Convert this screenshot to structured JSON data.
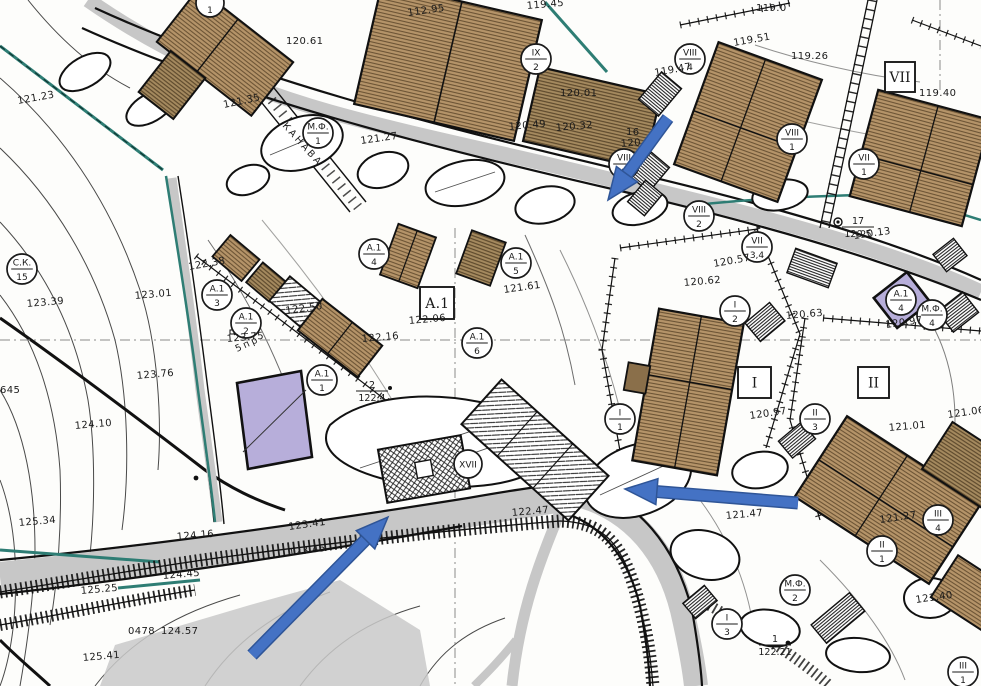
{
  "map": {
    "title": "Cadastral site plan",
    "colors": {
      "ink": "#1a1a1a",
      "building_fill": "#b59469",
      "building_line": "#6b5334",
      "road_gray": "#c7c7c7",
      "teal": "#2e7d74",
      "arrow_blue": "#4472c4",
      "arrow_blue_dark": "#2f5597",
      "highlight_purple": "#b7aeda"
    },
    "circle_labels": [
      {
        "x": 318,
        "y": 133,
        "top": "М.Ф.",
        "bot": "1"
      },
      {
        "x": 210,
        "y": 3,
        "top": "",
        "bot": "1"
      },
      {
        "x": 536,
        "y": 59,
        "top": "IX",
        "bot": "2"
      },
      {
        "x": 690,
        "y": 59,
        "top": "VIII",
        "bot": "4"
      },
      {
        "x": 624,
        "y": 164,
        "top": "VIII",
        "bot": "3"
      },
      {
        "x": 757,
        "y": 247,
        "top": "VII",
        "bot": "3,4"
      },
      {
        "x": 792,
        "y": 139,
        "top": "VIII",
        "bot": "1"
      },
      {
        "x": 864,
        "y": 164,
        "top": "VII",
        "bot": "1"
      },
      {
        "x": 699,
        "y": 216,
        "top": "VIII",
        "bot": "2"
      },
      {
        "x": 22,
        "y": 269,
        "top": "С.К.",
        "bot": "15"
      },
      {
        "x": 217,
        "y": 295,
        "top": "А.1",
        "bot": "3"
      },
      {
        "x": 246,
        "y": 323,
        "top": "А.1",
        "bot": "2"
      },
      {
        "x": 322,
        "y": 380,
        "top": "А.1",
        "bot": "1"
      },
      {
        "x": 374,
        "y": 254,
        "top": "А.1",
        "bot": "4"
      },
      {
        "x": 516,
        "y": 263,
        "top": "А.1",
        "bot": "5"
      },
      {
        "x": 477,
        "y": 343,
        "top": "А.1",
        "bot": "6"
      },
      {
        "x": 468,
        "y": 464,
        "top": "XVII",
        "bot": ""
      },
      {
        "x": 735,
        "y": 311,
        "top": "I",
        "bot": "2"
      },
      {
        "x": 815,
        "y": 419,
        "top": "II",
        "bot": "3"
      },
      {
        "x": 620,
        "y": 419,
        "top": "I",
        "bot": "1"
      },
      {
        "x": 938,
        "y": 520,
        "top": "III",
        "bot": "4"
      },
      {
        "x": 882,
        "y": 551,
        "top": "II",
        "bot": "1"
      },
      {
        "x": 795,
        "y": 590,
        "top": "М.Ф.",
        "bot": "2"
      },
      {
        "x": 727,
        "y": 624,
        "top": "I",
        "bot": "3"
      },
      {
        "x": 963,
        "y": 672,
        "top": "III",
        "bot": "1"
      },
      {
        "x": 932,
        "y": 315,
        "top": "М.Ф.",
        "bot": "4"
      },
      {
        "x": 901,
        "y": 300,
        "top": "А.1",
        "bot": "4"
      }
    ],
    "box_labels": [
      {
        "x": 885,
        "y": 62,
        "w": 30,
        "h": 30,
        "text": "VII"
      },
      {
        "x": 420,
        "y": 287,
        "w": 34,
        "h": 32,
        "text": "А.1"
      },
      {
        "x": 738,
        "y": 367,
        "w": 33,
        "h": 31,
        "text": "I"
      },
      {
        "x": 858,
        "y": 367,
        "w": 31,
        "h": 31,
        "text": "II"
      }
    ],
    "elevation_labels": [
      {
        "t": "121.23",
        "x": 18,
        "y": 104,
        "r": -10
      },
      {
        "t": "120.61",
        "x": 286,
        "y": 44,
        "r": 0
      },
      {
        "t": "112.95",
        "x": 408,
        "y": 16,
        "r": -8
      },
      {
        "t": "119.45",
        "x": 527,
        "y": 9,
        "r": -5
      },
      {
        "t": "121.35",
        "x": 224,
        "y": 108,
        "r": -12
      },
      {
        "t": "119.0",
        "x": 756,
        "y": 11,
        "r": 0
      },
      {
        "t": "119.51",
        "x": 734,
        "y": 46,
        "r": -10
      },
      {
        "t": "119.26",
        "x": 791,
        "y": 59,
        "r": 0
      },
      {
        "t": "119.40",
        "x": 919,
        "y": 96,
        "r": 0
      },
      {
        "t": "119.47",
        "x": 655,
        "y": 76,
        "r": -10
      },
      {
        "t": "120.01",
        "x": 560,
        "y": 96,
        "r": 0
      },
      {
        "t": "120.49",
        "x": 509,
        "y": 130,
        "r": -5
      },
      {
        "t": "120.32",
        "x": 556,
        "y": 131,
        "r": -5
      },
      {
        "t": "121.27",
        "x": 361,
        "y": 144,
        "r": -8
      },
      {
        "t": "16",
        "x": 626,
        "y": 135,
        "r": 0
      },
      {
        "t": "120.57",
        "x": 621,
        "y": 147,
        "r": -5
      },
      {
        "t": "120.13",
        "x": 854,
        "y": 239,
        "r": -8
      },
      {
        "t": "120.62",
        "x": 684,
        "y": 286,
        "r": -5
      },
      {
        "t": "120.57",
        "x": 714,
        "y": 267,
        "r": -10
      },
      {
        "t": "120.63",
        "x": 786,
        "y": 319,
        "r": -5
      },
      {
        "t": "120.97",
        "x": 886,
        "y": 328,
        "r": -8
      },
      {
        "t": "121.01",
        "x": 889,
        "y": 431,
        "r": -5
      },
      {
        "t": "121.06",
        "x": 948,
        "y": 418,
        "r": -8
      },
      {
        "t": "120.97",
        "x": 750,
        "y": 419,
        "r": -8
      },
      {
        "t": "121.61",
        "x": 504,
        "y": 293,
        "r": -8
      },
      {
        "t": "122.06",
        "x": 409,
        "y": 324,
        "r": -5
      },
      {
        "t": "122.50",
        "x": 286,
        "y": 314,
        "r": -8
      },
      {
        "t": "122.38",
        "x": 189,
        "y": 270,
        "r": -10
      },
      {
        "t": "123.75",
        "x": 227,
        "y": 342,
        "r": -5
      },
      {
        "t": "122.16",
        "x": 362,
        "y": 342,
        "r": -5
      },
      {
        "t": "123.39",
        "x": 27,
        "y": 307,
        "r": -5
      },
      {
        "t": "123.01",
        "x": 135,
        "y": 299,
        "r": -5
      },
      {
        "t": "123.76",
        "x": 137,
        "y": 379,
        "r": -5
      },
      {
        "t": "124.10",
        "x": 75,
        "y": 429,
        "r": -5
      },
      {
        "t": "645",
        "x": 0,
        "y": 393,
        "r": 0
      },
      {
        "t": "125.34",
        "x": 19,
        "y": 526,
        "r": -5
      },
      {
        "t": "124.16",
        "x": 177,
        "y": 540,
        "r": -5
      },
      {
        "t": "123.41",
        "x": 289,
        "y": 530,
        "r": -8
      },
      {
        "t": "123.45",
        "x": 289,
        "y": 556,
        "r": -8
      },
      {
        "t": "125.25",
        "x": 81,
        "y": 594,
        "r": -5
      },
      {
        "t": "124.45",
        "x": 163,
        "y": 579,
        "r": -5
      },
      {
        "t": "0478",
        "x": 128,
        "y": 634,
        "r": 0
      },
      {
        "t": "124.57",
        "x": 161,
        "y": 634,
        "r": 0
      },
      {
        "t": "125.41",
        "x": 83,
        "y": 661,
        "r": -5
      },
      {
        "t": "122.47",
        "x": 512,
        "y": 516,
        "r": -5
      },
      {
        "t": "121.47",
        "x": 726,
        "y": 519,
        "r": -5
      },
      {
        "t": "121.27",
        "x": 880,
        "y": 523,
        "r": -8
      },
      {
        "t": "121.40",
        "x": 916,
        "y": 603,
        "r": -8
      }
    ],
    "fraction_labels": [
      {
        "x": 372,
        "y": 391,
        "top": "2",
        "bot": "122.4"
      },
      {
        "x": 775,
        "y": 645,
        "top": "1",
        "bot": "122.21"
      },
      {
        "x": 858,
        "y": 227,
        "top": "17",
        "bot": "120.5"
      }
    ],
    "rotated_texts": [
      {
        "x": 282,
        "y": 126,
        "t": "КАНАВА",
        "r": 48
      },
      {
        "x": 237,
        "y": 352,
        "t": "5пр",
        "r": -25
      }
    ],
    "arrows": [
      {
        "x1": 668,
        "y1": 118,
        "x2": 608,
        "y2": 200
      },
      {
        "x1": 252,
        "y1": 655,
        "x2": 388,
        "y2": 517
      },
      {
        "x1": 798,
        "y1": 503,
        "x2": 625,
        "y2": 489
      }
    ]
  }
}
